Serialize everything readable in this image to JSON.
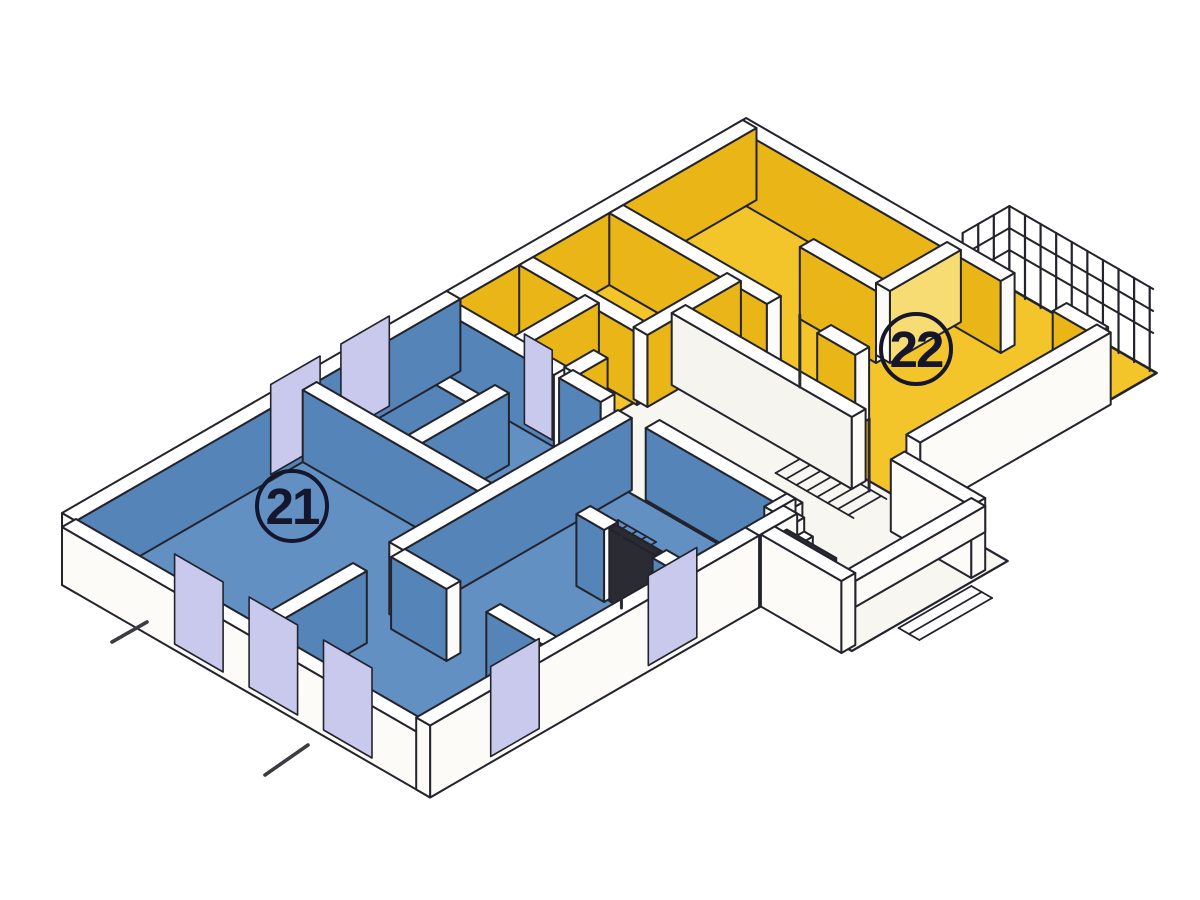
{
  "page": {
    "background": "#ffffff"
  },
  "diagram": {
    "type": "axonometric-floor-plan",
    "units": [
      {
        "id": "unit-21",
        "label": "21",
        "label_x": 292,
        "label_y": 506
      },
      {
        "id": "unit-22",
        "label": "22",
        "label_x": 916,
        "label_y": 349
      }
    ],
    "colors": {
      "blue_floor": "#6290c3",
      "blue_wall": "#5584b8",
      "yellow_floor": "#f3c52b",
      "yellow_wall": "#e9b517",
      "yellow_light": "#f6dc72",
      "hall_floor": "#f7f6f1",
      "hall_wall": "#f6f4ee",
      "white": "#fcfbf7",
      "cap": "#ffffff",
      "window": "#c9c9ee",
      "door": "#2b2b33",
      "outline": "#23232c",
      "dash": "#3c3c44",
      "label_ink": "#15152c"
    },
    "features": [
      "stair-hall",
      "balcony-railing",
      "entrance-porch",
      "section-dash-marks"
    ]
  }
}
